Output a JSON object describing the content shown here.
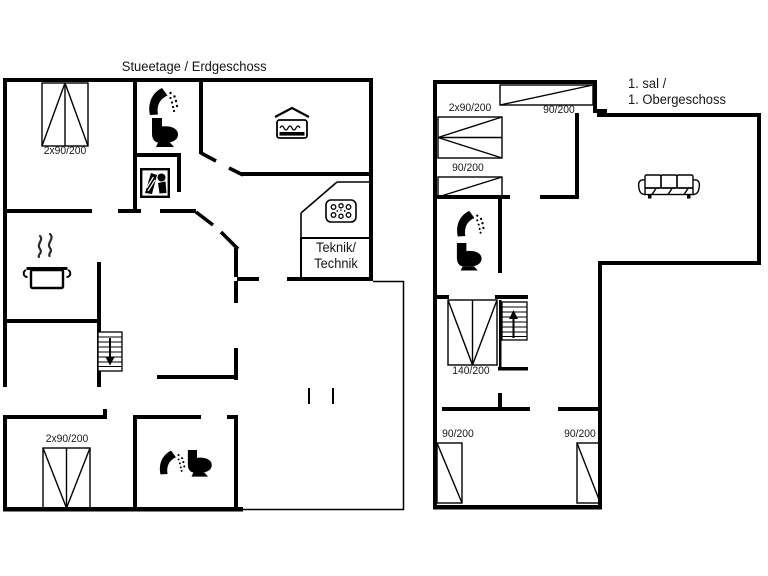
{
  "page": {
    "background": "#ffffff",
    "ink": "#000000"
  },
  "titles": {
    "ground": "Stueetage / Erdgeschoss",
    "first_line1": "1. sal /",
    "first_line2": "1. Obergeschoss"
  },
  "ground_floor": {
    "beds": {
      "top_left": "2x90/200",
      "annex": "2x90/200"
    },
    "utility": {
      "line1": "Teknik/",
      "line2": "Technik"
    },
    "icons": [
      "shower-icon",
      "toilet-icon",
      "washing-machine-icon",
      "double-bed-icon",
      "cooking-pot-icon",
      "stove-hob-icon",
      "stairs-down-icon",
      "shower-icon",
      "toilet-icon"
    ]
  },
  "first_floor": {
    "beds": {
      "bunk": "2x90/200",
      "single": "90/200",
      "top": "90/200",
      "double": "140/200",
      "bottom_left": "90/200",
      "bottom_right": "90/200"
    },
    "icons": [
      "shower-icon",
      "toilet-icon",
      "sofa-icon",
      "stairs-up-icon"
    ]
  }
}
